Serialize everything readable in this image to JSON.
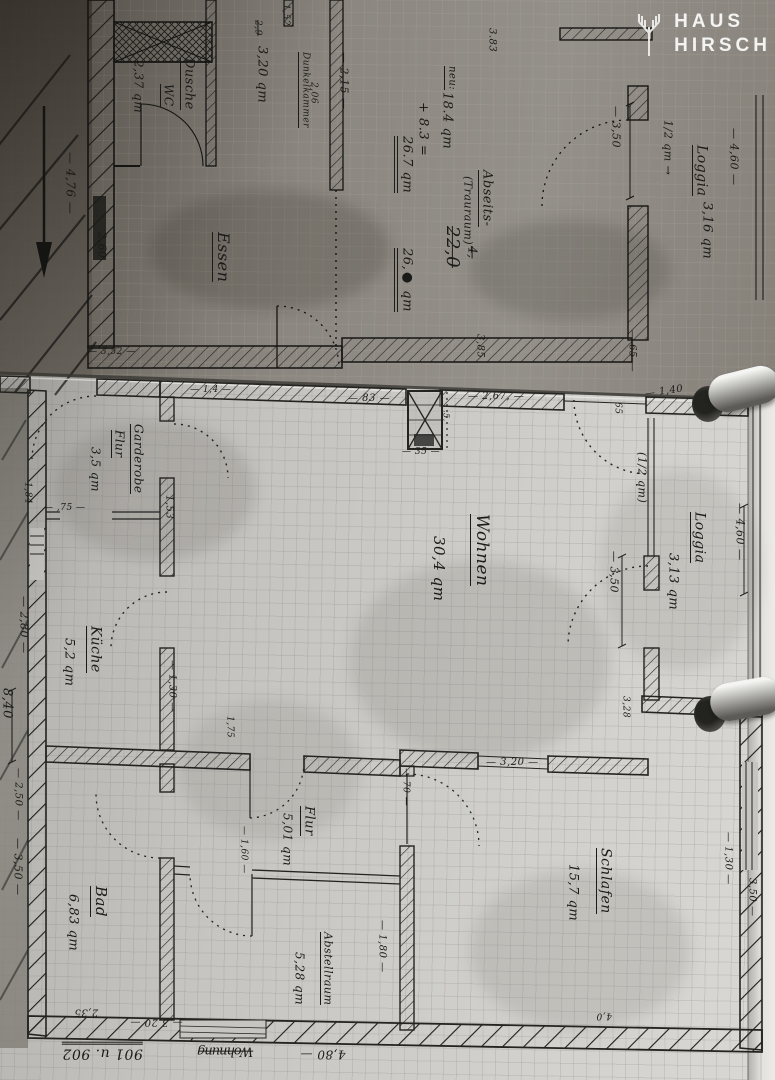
{
  "logo": {
    "line1": "HAUS",
    "line2": "HIRSCH"
  },
  "top_sheet": {
    "dusche": {
      "name": "Dusche",
      "name2": "WC",
      "area": "2,37 qm"
    },
    "dunkelkammer": {
      "name": "Dunkelkammer",
      "area": "3,20 qm",
      "struck": "2,9"
    },
    "essen": {
      "name": "Essen"
    },
    "loggia": {
      "note": "1/2 qm →",
      "name": "Loggia",
      "area": "3,16 qm"
    },
    "calc": {
      "title": "Abseits-",
      "subtitle": "(Trauraum)",
      "note": "neu:",
      "col1": "18.4 qm",
      "col1_struck": "22,0",
      "col2": "+ 8.3 =",
      "col2_struck": "4,",
      "result": "26.7 qm",
      "result2": "26,● qm"
    },
    "dims": {
      "d215": "— 2,15 —",
      "d206": "2,06",
      "d152": "1,52",
      "d383": "3.83",
      "d476": "— 4,76 —",
      "d260": "2,60",
      "d352": "— 3,52 —",
      "d385": "3,85",
      "d65": "— 65 —",
      "d460": "— 4,60 —",
      "d350": "— 3,50"
    }
  },
  "bottom_sheet": {
    "garderobe": {
      "name": "Garderobe",
      "name2": "Flur",
      "area": "3,5 qm"
    },
    "kueche": {
      "name": "Küche",
      "area": "5,2 qm"
    },
    "wohnen": {
      "name": "Wohnen",
      "area": "30,4 qm"
    },
    "loggia": {
      "note": "(1/2 qm)",
      "name": "Loggia",
      "area": "3,13 qm"
    },
    "bad": {
      "name": "Bad",
      "area": "6,83 qm"
    },
    "flur": {
      "name": "Flur",
      "area": "5,01 qm"
    },
    "abstellraum": {
      "name": "Abstellraum",
      "area": "5,28 qm"
    },
    "schlafen": {
      "name": "Schlafen",
      "area": "15,7 qm"
    },
    "dims": {
      "d14": "— 1,4 —",
      "d83": "— 83 —",
      "d267": "— 2,67, —",
      "d35": "— 35 —",
      "d05": ".5,",
      "d140": "— 1,40",
      "d65": "65",
      "d184": "1,84",
      "d75": "— ,75 —",
      "d153": "1,53",
      "d280": "— 2,80 —",
      "d130": "— 1,30 —",
      "d175": "1,75",
      "d460": "— 4,60 —",
      "d350loggia": "— 3,50",
      "d328": "3,28",
      "d70": "— 70 —",
      "d320": "— 3,20 —",
      "d160": "— 1,60 —",
      "d180": "— 1,80 —",
      "d130r": "— 1,30 —",
      "d350r": "3,50 —",
      "d840": "8,40",
      "d250": "— 2,50 —",
      "d350l": "— 3,50 —",
      "d320b": "— 3,20 —",
      "d235": "2,35",
      "d40": "4,0"
    }
  },
  "footer": {
    "dim": "4,80 —",
    "label_struck": "Wohnung",
    "number": "901 u. 902"
  }
}
